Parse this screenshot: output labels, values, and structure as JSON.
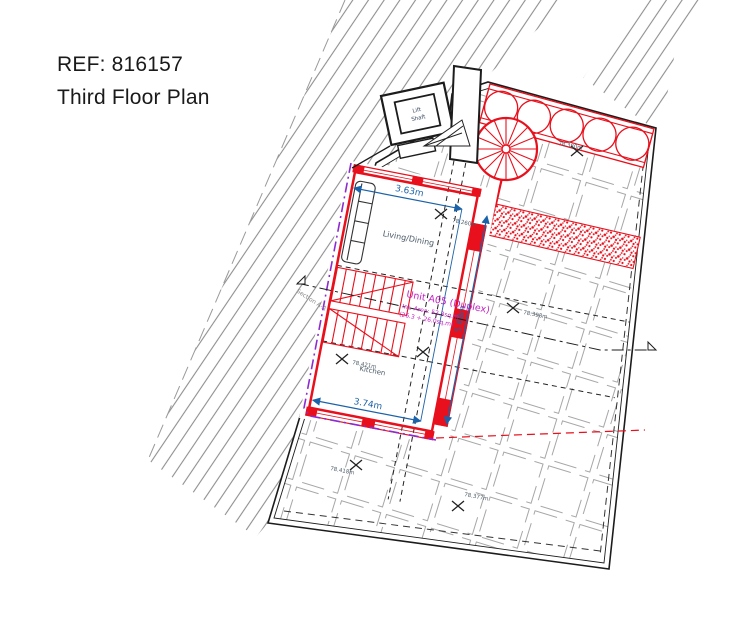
{
  "header": {
    "ref": "REF: 816157",
    "title": "Third Floor Plan"
  },
  "plan": {
    "unit": {
      "name": "Unit A05 (Duplex)",
      "area": "Int. Area: 52.3sq.m",
      "area_split": "(26.3 + 26.0sq.m)"
    },
    "rooms": {
      "living": "Living/Dining",
      "kitchen": "Kitchen",
      "lift_line1": "Lift",
      "lift_line2": "Shaft"
    },
    "dimensions": {
      "living_width": "3.63m",
      "unit_height": "5.68m",
      "kitchen_width": "3.74m"
    },
    "section_label": "Section A-A",
    "levels": [
      {
        "id": "terrace-top",
        "value": "78.380m"
      },
      {
        "id": "living",
        "value": "78.260m"
      },
      {
        "id": "terrace-right",
        "value": "78.398m"
      },
      {
        "id": "kitchen",
        "value": "78.421m"
      },
      {
        "id": "terrace-bottom-left",
        "value": "78.418m"
      },
      {
        "id": "terrace-bottom-right",
        "value": "78.377m"
      }
    ],
    "colors": {
      "wall_red": "#e8101c",
      "dimension_blue": "#1c62a8",
      "unit_magenta": "#c321c3",
      "boundary_purple": "#8e2bd0",
      "hatch_grey": "#8f8f8f",
      "tile_grey": "#a6a6a6",
      "ink": "#1c1c1c",
      "label_grey": "#4c5b68"
    }
  }
}
